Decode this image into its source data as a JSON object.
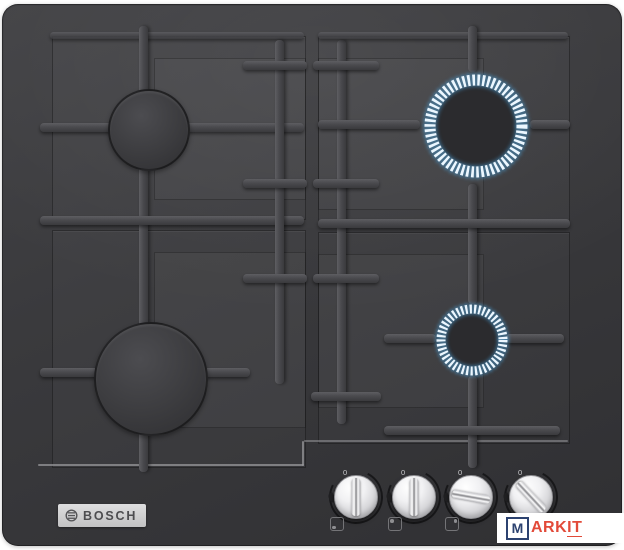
{
  "hob": {
    "brand": "BOSCH",
    "surface": "black tempered glass",
    "burners": [
      {
        "name": "back-left",
        "lit": false,
        "size": "medium"
      },
      {
        "name": "front-left",
        "lit": false,
        "size": "large"
      },
      {
        "name": "back-right",
        "lit": true,
        "size": "large"
      },
      {
        "name": "front-right",
        "lit": true,
        "size": "small"
      }
    ],
    "knobs": [
      {
        "name": "knob-front-left",
        "marker": "0",
        "state": "off",
        "burner_icon": "dot-bottom-left"
      },
      {
        "name": "knob-back-left",
        "marker": "0",
        "state": "off",
        "burner_icon": "dot-top-left"
      },
      {
        "name": "knob-back-right",
        "marker": "0",
        "state": "on",
        "burner_icon": "dot-top-right"
      },
      {
        "name": "knob-front-right",
        "marker": "0",
        "state": "on",
        "burner_icon": "dot-bottom-right"
      }
    ]
  },
  "watermark": {
    "letter_m": "M",
    "letters_ark": "ARK",
    "letters_it": "IT"
  },
  "colors": {
    "hob_base": "#3a3a3d",
    "flame_tick": "#ecf7ff",
    "flame_glow": "#4aa4e0",
    "badge_silver": "#cfcfcf",
    "watermark_navy": "#2c4270",
    "watermark_red": "#e24a39"
  }
}
